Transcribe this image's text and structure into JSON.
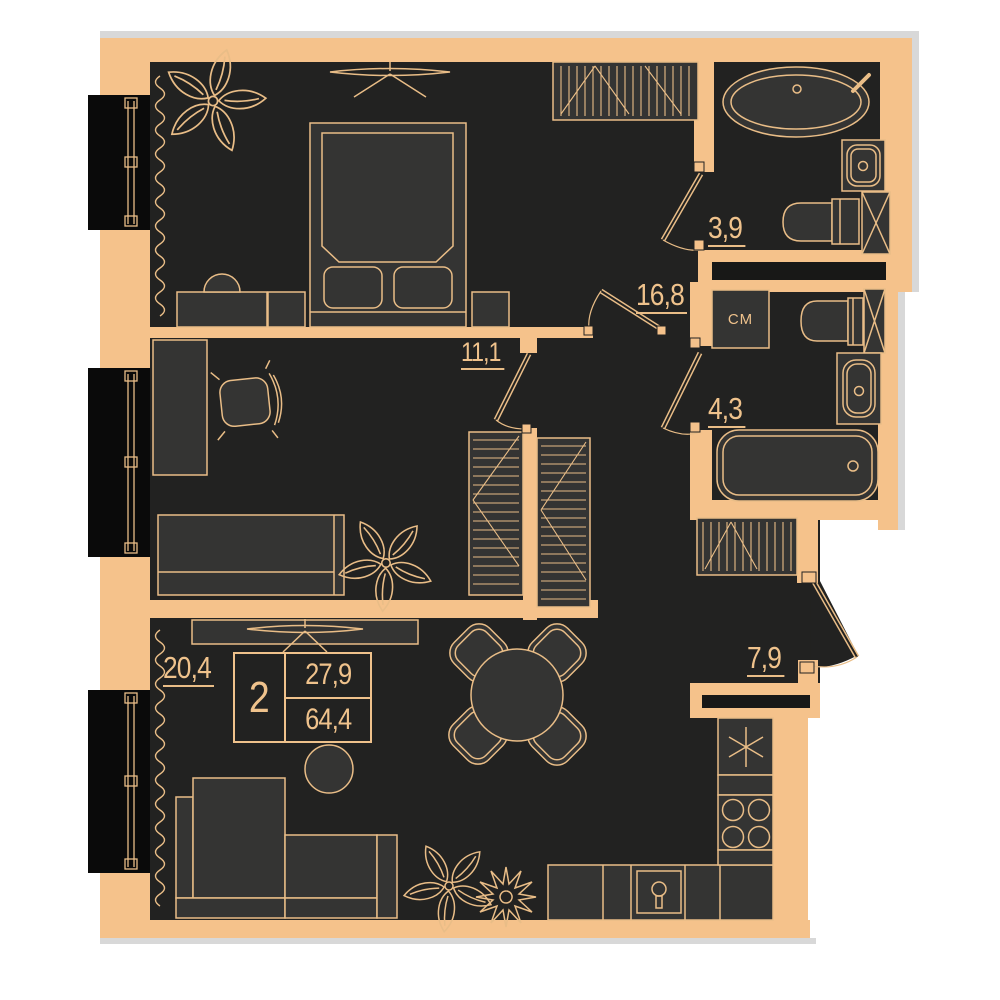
{
  "plan": {
    "title": "2-room apartment floor plan",
    "rooms_count": "2",
    "living_area": "27,9",
    "total_area": "64,4",
    "rooms": {
      "bedroom": "16,8",
      "room": "11,1",
      "bathroom": "3,9",
      "bathroom2": "4,3",
      "hall": "7,9",
      "living_kitchen": "20,4"
    },
    "washing_machine": "СМ",
    "colors": {
      "wall": "#f5c28b",
      "floor": "#222221",
      "furniture_fill": "#343433",
      "outline": "#e9bd87",
      "window_glass": "#0a0a0a",
      "niche": "#181817",
      "shadow": "#d8d8d8",
      "background": "#ffffff"
    }
  }
}
